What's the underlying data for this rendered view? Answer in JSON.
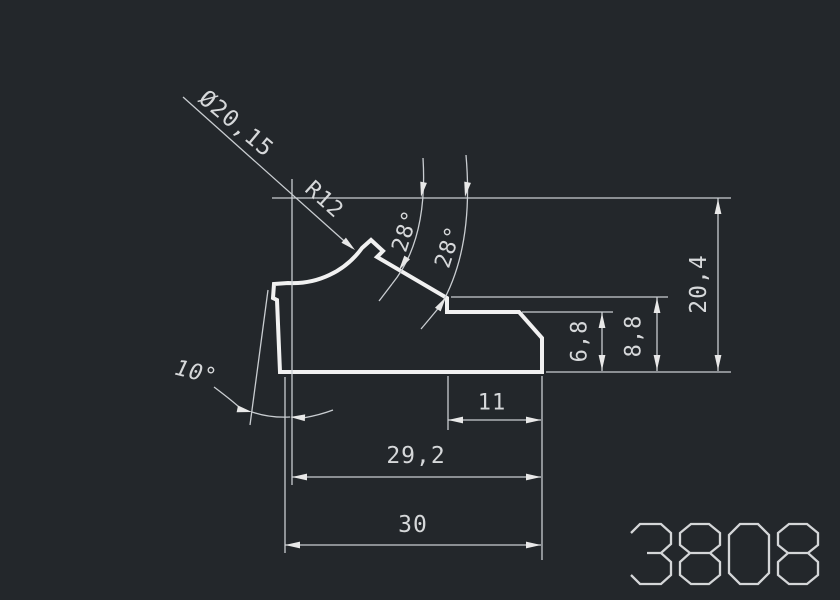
{
  "drawing": {
    "part_number": "3808",
    "colors": {
      "background": "#23272b",
      "profile_line": "#f1f1f1",
      "dimension_line": "#c9cdd1",
      "text": "#d6d8da"
    },
    "dimensions": {
      "diameter_label": "Ø20,15",
      "radius_label": "R12",
      "angle_label_1": "28°",
      "angle_label_2": "28°",
      "draft_angle_label": "10°",
      "total_height_label": "20,4",
      "outer_step_height_label": "8,8",
      "inner_step_height_label": "6,8",
      "step_width_label": "11",
      "inner_width_label": "29,2",
      "total_width_label": "30"
    }
  }
}
